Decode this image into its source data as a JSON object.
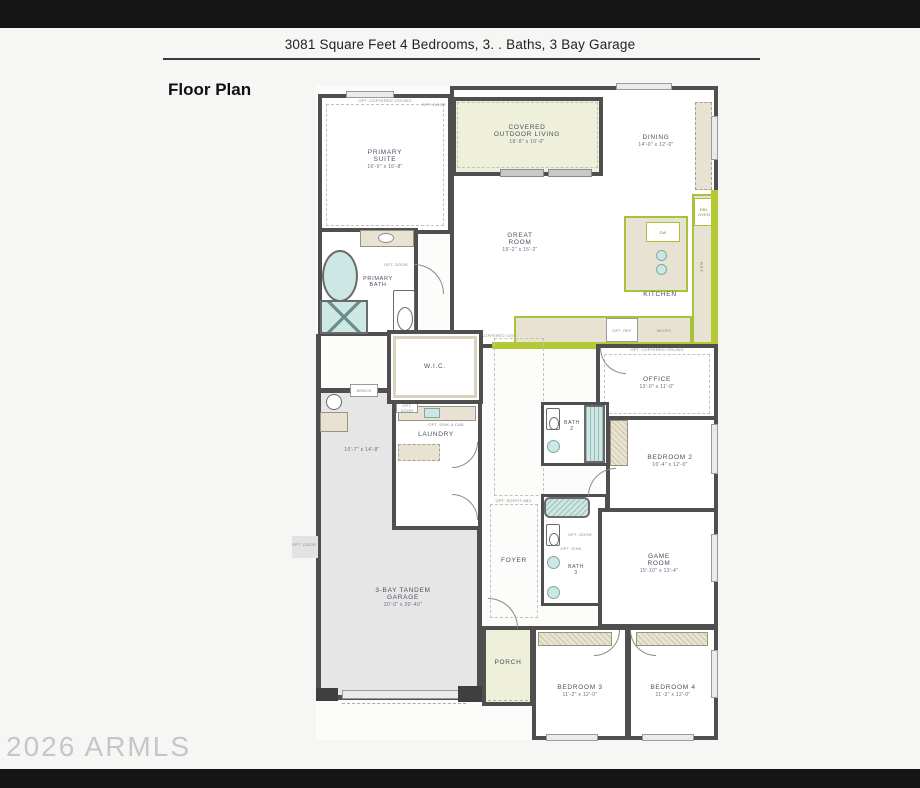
{
  "page": {
    "header_title": "3081 Square Feet 4 Bedrooms, 3. . Baths, 3 Bay Garage",
    "section_title": "Floor Plan",
    "watermark": "2026 ARMLS"
  },
  "rooms": {
    "primary_suite": {
      "name": "PRIMARY\nSUITE",
      "dims": "16'-0\" x 16'-8\""
    },
    "covered_outdoor_living": {
      "name": "COVERED\nOUTDOOR LIVING",
      "dims": "18'-8\" x 10'-0\""
    },
    "dining": {
      "name": "DINING",
      "dims": "14'-0\" x 12'-0\""
    },
    "great_room": {
      "name": "GREAT\nROOM",
      "dims": "19'-2\" x 15'-2\""
    },
    "kitchen": {
      "name": "KITCHEN"
    },
    "primary_bath": {
      "name": "PRIMARY\nBATH"
    },
    "wic": {
      "name": "W.I.C."
    },
    "office": {
      "name": "OFFICE",
      "dims": "13'-0\" x 11'-0\""
    },
    "laundry": {
      "name": "LAUNDRY"
    },
    "bath2": {
      "name": "BATH\n2"
    },
    "bedroom2": {
      "name": "BEDROOM 2",
      "dims": "10'-4\" x 12'-0\""
    },
    "foyer": {
      "name": "FOYER"
    },
    "bath3": {
      "name": "BATH\n3"
    },
    "game_room": {
      "name": "GAME\nROOM",
      "dims": "15'-10\" x 13'-4\""
    },
    "garage": {
      "name": "3-BAY TANDEM\nGARAGE",
      "dims": "20'-0\" x 20'-40\"",
      "tandem_dims": "10'-7\" x 14'-8\""
    },
    "porch": {
      "name": "PORCH"
    },
    "bedroom3": {
      "name": "BEDROOM 3",
      "dims": "11'-2\" x 12'-0\""
    },
    "bedroom4": {
      "name": "BEDROOM 4",
      "dims": "11'-3\" x 12'-0\""
    }
  },
  "annotations": {
    "opt_coffered_ceiling": "OPT. COFFERED CEILING",
    "opt_door": "OPT. DOOR",
    "opt_ref": "OPT. REF",
    "micro": "MICRO",
    "dw": "DW",
    "ref": "REF",
    "dbl_oven": "DBL OVEN",
    "opt_sink": "OPT. SINK",
    "opt_sink_cab": "OPT. SINK & CAB",
    "bench": "BENCH",
    "opt_soffit": "OPT. SOFFIT ABV."
  },
  "colors": {
    "wall": "#4f4f4f",
    "accent_green": "#b4c934",
    "outdoor_fill": "#eef0da",
    "counter_fill": "#e7e2d2",
    "garage_fill": "#e6e6e6",
    "fixture_blue": "#cde7e4"
  }
}
